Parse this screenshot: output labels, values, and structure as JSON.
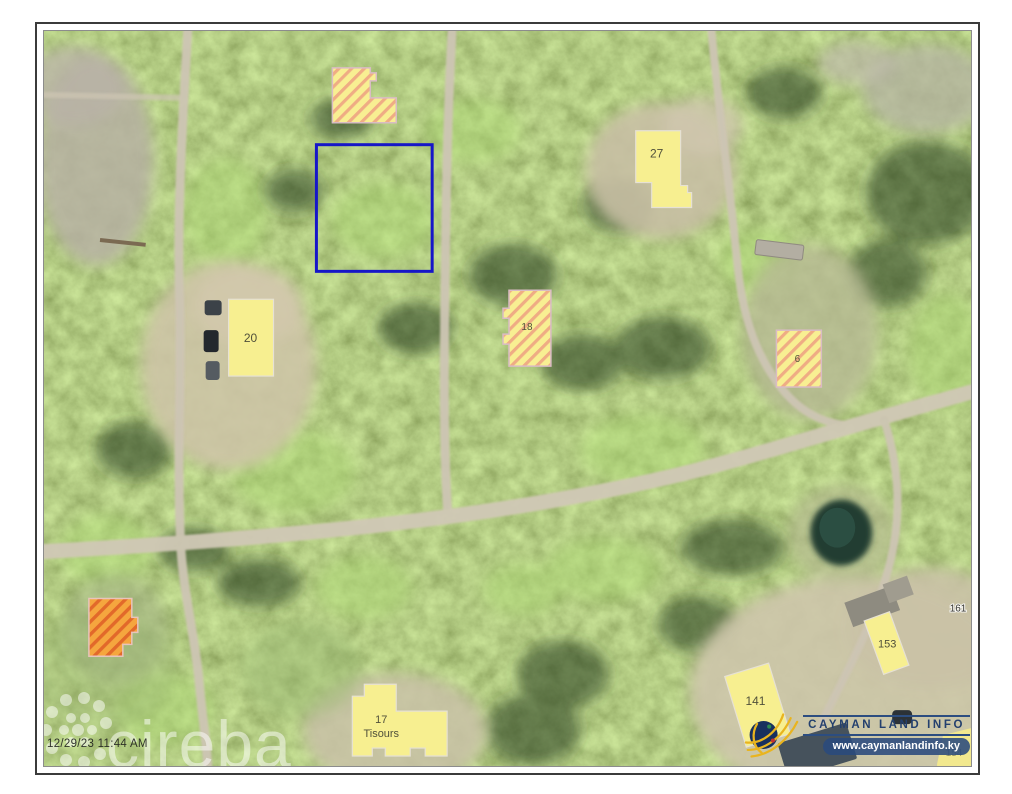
{
  "map": {
    "timestamp": "12/29/23 11:44 AM",
    "watermark_brand": "cireba",
    "buildings": {
      "b20": "20",
      "b27": "27",
      "b18": "18",
      "b6": "6",
      "b17_number": "17",
      "b17_name": "Tisours",
      "b141": "141",
      "b153": "153",
      "b154": "154"
    },
    "lot_labels": {
      "l161": "161"
    },
    "colors": {
      "selection_outline": "#1616c8",
      "building_yellow": "#f7ef90",
      "hatch_stripe": "#efac84",
      "building_orange": "#f5a63e",
      "orange_stripe": "#e2692a",
      "road": "#cdc5b3"
    }
  },
  "branding": {
    "title": "CAYMAN LAND INFO",
    "website": "www.caymanlandinfo.ky"
  }
}
